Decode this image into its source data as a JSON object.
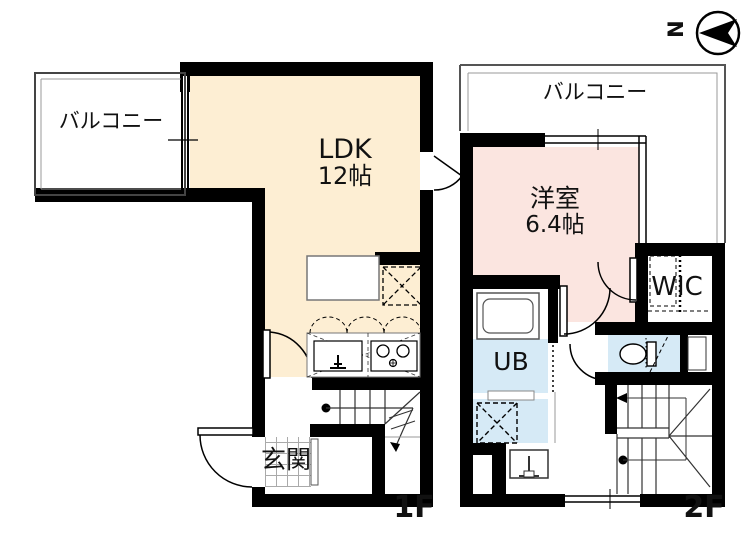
{
  "compass": {
    "north_label": "N"
  },
  "floor1": {
    "floor_label": "1F",
    "balcony_label": "バルコニー",
    "ldk_label": "LDK",
    "ldk_size": "12帖",
    "entrance_label": "玄関"
  },
  "floor2": {
    "floor_label": "2F",
    "balcony_label": "バルコニー",
    "room_label": "洋室",
    "room_size": "6.4帖",
    "wic_label": "WIC",
    "bath_label": "UB"
  },
  "colors": {
    "ldk_fill": "#fdeed3",
    "western_room_fill": "#fbe5e0",
    "wet_area_fill": "#d6eaf6",
    "wall": "#000000"
  }
}
